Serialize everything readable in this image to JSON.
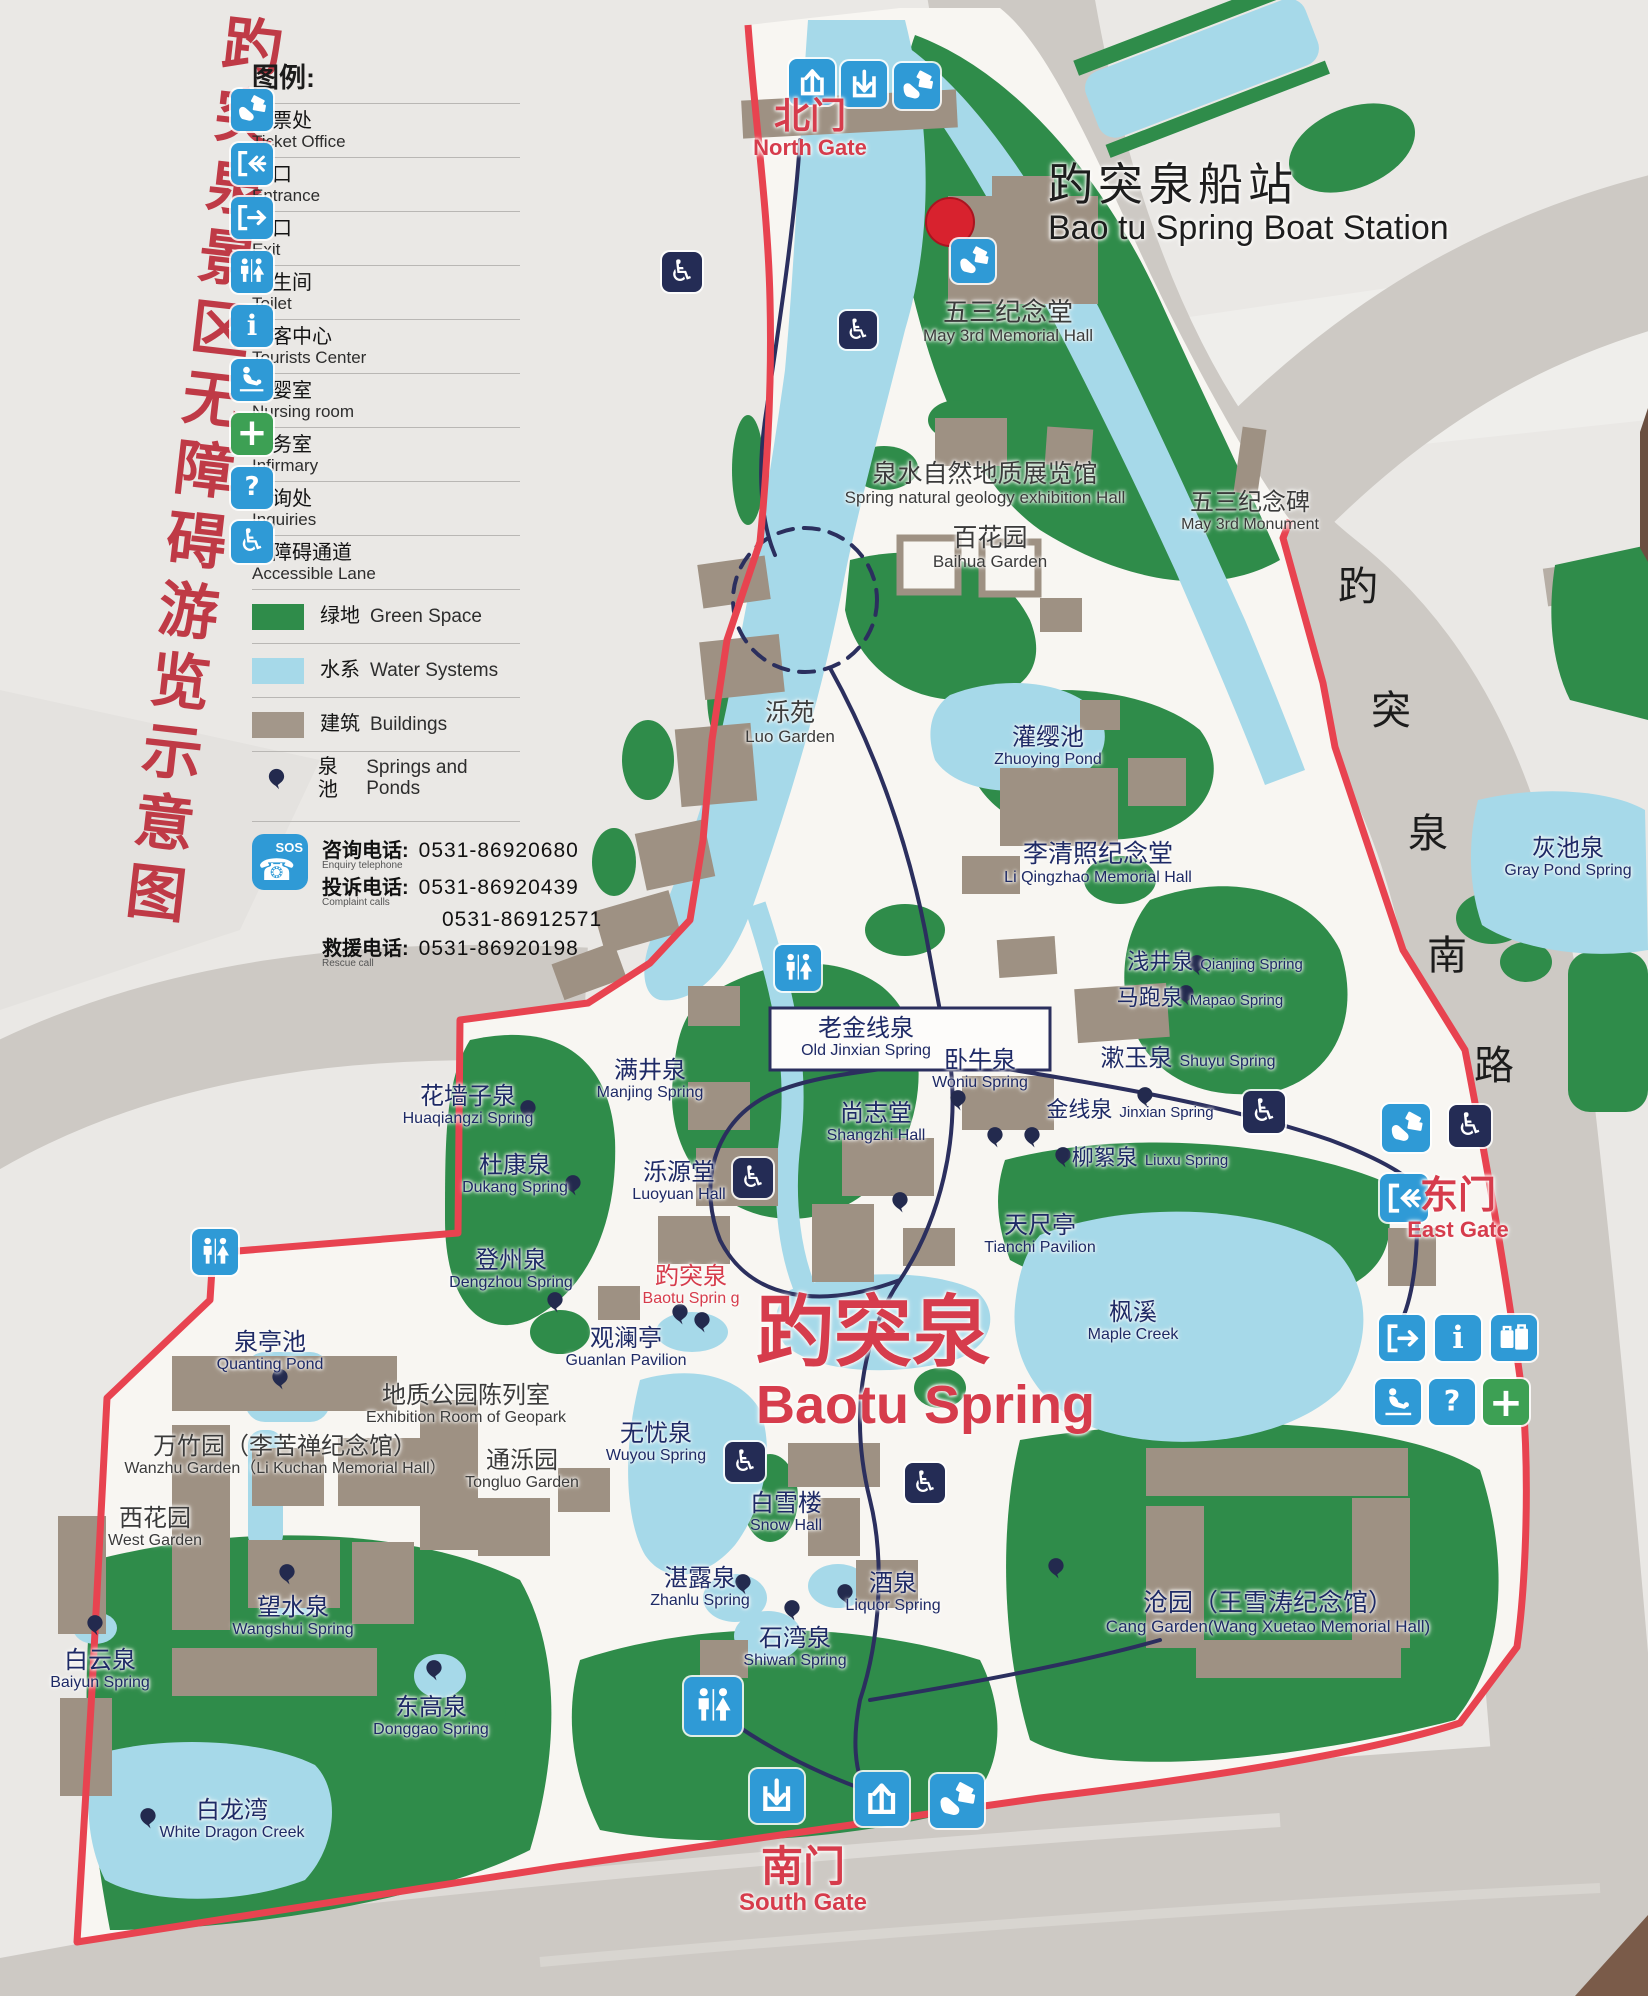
{
  "poster": {
    "vertical_title": "趵突泉景区无障碍游览示意图",
    "colors": {
      "title_red": "#bf3a46",
      "boundary_red": "#e84350",
      "gate_red": "#d63c4c",
      "label_navy": "#1e2a66",
      "green_space": "#2f8c4a",
      "water": "#a6d9e9",
      "building": "#9e9183",
      "road_gray": "#cdc9c4",
      "icon_blue": "#2f9ad6",
      "icon_navy": "#242c55",
      "infirmary_green": "#3da054"
    }
  },
  "legend": {
    "title": "图例:",
    "items": [
      {
        "id": "ticket-office",
        "icon": "ticket",
        "zh": "售票处",
        "en": "Ticket Office"
      },
      {
        "id": "entrance",
        "icon": "door-in",
        "zh": "入口",
        "en": "Entrance"
      },
      {
        "id": "exit",
        "icon": "door-out",
        "zh": "出口",
        "en": "Exit"
      },
      {
        "id": "toilet",
        "icon": "toilet",
        "zh": "卫生间",
        "en": "Toilet"
      },
      {
        "id": "tourists-center",
        "icon": "info",
        "zh": "游客中心",
        "en": "Tourists Center"
      },
      {
        "id": "nursing-room",
        "icon": "nursing",
        "zh": "母婴室",
        "en": "Nursing room"
      },
      {
        "id": "infirmary",
        "icon": "cross",
        "zh": "医务室",
        "en": "Infirmary"
      },
      {
        "id": "inquiries",
        "icon": "question",
        "zh": "咨询处",
        "en": "Inquiries"
      },
      {
        "id": "accessible-lane",
        "icon": "wheelchair-blue",
        "zh": "无障碍通道",
        "en": "Accessible Lane"
      },
      {
        "id": "green-space",
        "swatch": "green",
        "zh": "绿地",
        "en": "Green Space",
        "oneline": true
      },
      {
        "id": "water-systems",
        "swatch": "water",
        "zh": "水系",
        "en": "Water Systems",
        "oneline": true
      },
      {
        "id": "buildings",
        "swatch": "building",
        "zh": "建筑",
        "en": "Buildings",
        "oneline": true
      },
      {
        "id": "springs-and-ponds",
        "swatch": "balloon",
        "zh": "泉池",
        "en": "Springs and Ponds",
        "oneline": true
      }
    ],
    "phones": {
      "sos": "SOS",
      "rows": [
        {
          "zh": "咨询电话:",
          "en": "Enquiry telephone",
          "numbers": [
            "0531-86920680"
          ]
        },
        {
          "zh": "投诉电话:",
          "en": "Complaint calls",
          "numbers": [
            "0531-86920439",
            "0531-86912571"
          ]
        },
        {
          "zh": "救援电话:",
          "en": "Rescue call",
          "numbers": [
            "0531-86920198"
          ]
        }
      ]
    }
  },
  "map": {
    "road_name": {
      "text": "趵突泉南路",
      "chars": [
        {
          "ch": "趵",
          "x": 1358,
          "y": 583
        },
        {
          "ch": "突",
          "x": 1391,
          "y": 707
        },
        {
          "ch": "泉",
          "x": 1428,
          "y": 830
        },
        {
          "ch": "南",
          "x": 1447,
          "y": 952
        },
        {
          "ch": "路",
          "x": 1494,
          "y": 1062
        }
      ]
    },
    "labels": [
      {
        "id": "north-gate-label",
        "zh": "北门",
        "en": "North Gate",
        "x": 810,
        "y": 96,
        "c": "red",
        "zs": 36,
        "es": 22,
        "b": 1
      },
      {
        "id": "boat-station-label",
        "zh": "趵突泉船站",
        "en": "Bao tu Spring Boat Station",
        "x": 1048,
        "y": 160,
        "c": "black",
        "zs": 45,
        "es": 34,
        "align": "left",
        "ls": 5
      },
      {
        "id": "may3rd-hall-label",
        "zh": "五三纪念堂",
        "en": "May 3rd Memorial Hall",
        "x": 1008,
        "y": 298,
        "c": "dark",
        "zs": 26,
        "es": 17
      },
      {
        "id": "geology-hall-label",
        "zh": "泉水自然地质展览馆",
        "en": "Spring natural geology exhibition Hall",
        "x": 985,
        "y": 461,
        "c": "dark",
        "zs": 25,
        "es": 17
      },
      {
        "id": "baihua-garden-label",
        "zh": "百花园",
        "en": "Baihua Garden",
        "x": 990,
        "y": 525,
        "c": "dark",
        "zs": 25,
        "es": 17
      },
      {
        "id": "may3rd-monument-label",
        "zh": "五三纪念碑",
        "en": "May 3rd Monument",
        "x": 1250,
        "y": 490,
        "c": "dark",
        "zs": 24,
        "es": 16
      },
      {
        "id": "luo-garden-label",
        "zh": "泺苑",
        "en": "Luo Garden",
        "x": 790,
        "y": 700,
        "c": "dark",
        "zs": 25,
        "es": 17
      },
      {
        "id": "zhuoying-pond-label",
        "zh": "灌缨池",
        "en": "Zhuoying Pond",
        "x": 1048,
        "y": 725,
        "c": "navy",
        "zs": 24,
        "es": 16
      },
      {
        "id": "liqingzhao-hall-label",
        "zh": "李清照纪念堂",
        "en": "Li Qingzhao Memorial Hall",
        "x": 1098,
        "y": 841,
        "c": "navy",
        "zs": 25,
        "es": 16
      },
      {
        "id": "gray-pond-spring-label",
        "zh": "灰池泉",
        "en": "Gray Pond Spring",
        "x": 1568,
        "y": 836,
        "c": "navy",
        "zs": 24,
        "es": 16
      },
      {
        "id": "qianjing-spring-label",
        "zh": "浅井泉",
        "en": "Qianjing Spring",
        "x": 1215,
        "y": 950,
        "c": "navy",
        "zs": 22,
        "es": 15,
        "inline": 1
      },
      {
        "id": "mapao-spring-label",
        "zh": "马跑泉",
        "en": "Mapao Spring",
        "x": 1200,
        "y": 986,
        "c": "navy",
        "zs": 22,
        "es": 15,
        "inline": 1
      },
      {
        "id": "old-jinxian-spring-label",
        "zh": "老金线泉",
        "en": "Old Jinxian Spring",
        "x": 866,
        "y": 1016,
        "c": "navy",
        "zs": 24,
        "es": 16
      },
      {
        "id": "woniu-spring-label",
        "zh": "卧牛泉",
        "en": "Woniu Spring",
        "x": 980,
        "y": 1048,
        "c": "navy",
        "zs": 24,
        "es": 16
      },
      {
        "id": "shuyu-spring-label",
        "zh": "漱玉泉",
        "en": "Shuyu Spring",
        "x": 1188,
        "y": 1046,
        "c": "navy",
        "zs": 24,
        "es": 16,
        "inline": 1
      },
      {
        "id": "shangzhi-hall-label",
        "zh": "尚志堂",
        "en": "Shangzhi Hall",
        "x": 876,
        "y": 1101,
        "c": "navy",
        "zs": 24,
        "es": 16
      },
      {
        "id": "jinxian-spring-label",
        "zh": "金线泉",
        "en": "Jinxian Spring",
        "x": 1130,
        "y": 1098,
        "c": "navy",
        "zs": 22,
        "es": 15,
        "inline": 1
      },
      {
        "id": "liuxu-spring-label",
        "zh": "柳絮泉",
        "en": "Liuxu Spring",
        "x": 1150,
        "y": 1146,
        "c": "navy",
        "zs": 22,
        "es": 15,
        "inline": 1
      },
      {
        "id": "tianchi-pavilion-label",
        "zh": "天尺亭",
        "en": "Tianchi Pavilion",
        "x": 1040,
        "y": 1213,
        "c": "navy",
        "zs": 24,
        "es": 16
      },
      {
        "id": "huaqiangzi-spring-label",
        "zh": "花墙子泉",
        "en": "Huaqiangzi Spring",
        "x": 468,
        "y": 1084,
        "c": "navy",
        "zs": 24,
        "es": 16
      },
      {
        "id": "manjing-spring-label",
        "zh": "满井泉",
        "en": "Manjing Spring",
        "x": 650,
        "y": 1058,
        "c": "navy",
        "zs": 24,
        "es": 16
      },
      {
        "id": "dukang-spring-label",
        "zh": "杜康泉",
        "en": "Dukang Spring",
        "x": 515,
        "y": 1153,
        "c": "navy",
        "zs": 24,
        "es": 16
      },
      {
        "id": "luoyuan-hall-label",
        "zh": "泺源堂",
        "en": "Luoyuan Hall",
        "x": 679,
        "y": 1160,
        "c": "navy",
        "zs": 24,
        "es": 16
      },
      {
        "id": "dengzhou-spring-label",
        "zh": "登州泉",
        "en": "Dengzhou Spring",
        "x": 511,
        "y": 1248,
        "c": "navy",
        "zs": 24,
        "es": 16
      },
      {
        "id": "baotu-spring-small-label",
        "zh": "趵突泉",
        "en": "Baotu Sprin g",
        "x": 691,
        "y": 1264,
        "c": "red",
        "zs": 24,
        "es": 16
      },
      {
        "id": "guanlan-pavilion-label",
        "zh": "观澜亭",
        "en": "Guanlan Pavilion",
        "x": 626,
        "y": 1326,
        "c": "navy",
        "zs": 24,
        "es": 16
      },
      {
        "id": "baotu-spring-title",
        "zh": "趵突泉",
        "en": "Baotu Spring",
        "x": 756,
        "y": 1290,
        "c": "red",
        "zs": 78,
        "es": 54,
        "align": "left",
        "b": 1
      },
      {
        "id": "maple-creek-label",
        "zh": "枫溪",
        "en": "Maple Creek",
        "x": 1133,
        "y": 1300,
        "c": "navy",
        "zs": 24,
        "es": 16
      },
      {
        "id": "wuyou-spring-label",
        "zh": "无忧泉",
        "en": "Wuyou Spring",
        "x": 656,
        "y": 1421,
        "c": "navy",
        "zs": 24,
        "es": 16
      },
      {
        "id": "snow-hall-label",
        "zh": "白雪楼",
        "en": "Snow Hall",
        "x": 786,
        "y": 1491,
        "c": "navy",
        "zs": 24,
        "es": 16
      },
      {
        "id": "zhanlu-spring-label",
        "zh": "湛露泉",
        "en": "Zhanlu Spring",
        "x": 700,
        "y": 1566,
        "c": "navy",
        "zs": 24,
        "es": 16
      },
      {
        "id": "liquor-spring-label",
        "zh": "酒泉",
        "en": "Liquor Spring",
        "x": 893,
        "y": 1571,
        "c": "navy",
        "zs": 24,
        "es": 16
      },
      {
        "id": "shiwan-spring-label",
        "zh": "石湾泉",
        "en": "Shiwan Spring",
        "x": 795,
        "y": 1626,
        "c": "navy",
        "zs": 24,
        "es": 16
      },
      {
        "id": "east-gate-label",
        "zh": "东门",
        "en": "East Gate",
        "x": 1458,
        "y": 1176,
        "c": "red",
        "zs": 38,
        "es": 22,
        "b": 1
      },
      {
        "id": "south-gate-label",
        "zh": "南门",
        "en": "South Gate",
        "x": 803,
        "y": 1844,
        "c": "red",
        "zs": 42,
        "es": 24,
        "b": 1
      },
      {
        "id": "quanting-pond-label",
        "zh": "泉亭池",
        "en": "Quanting Pond",
        "x": 270,
        "y": 1330,
        "c": "navy",
        "zs": 24,
        "es": 16
      },
      {
        "id": "geopark-room-label",
        "zh": "地质公园陈列室",
        "en": "Exhibition Room of Geopark",
        "x": 466,
        "y": 1383,
        "c": "dark",
        "zs": 24,
        "es": 16
      },
      {
        "id": "wanzhu-garden-label",
        "zh": "万竹园（李苦禅纪念馆）",
        "en": "Wanzhu Garden（Li Kuchan Memorial Hall）",
        "x": 285,
        "y": 1434,
        "c": "dark",
        "zs": 24,
        "es": 16
      },
      {
        "id": "west-garden-label",
        "zh": "西花园",
        "en": "West Garden",
        "x": 155,
        "y": 1506,
        "c": "dark",
        "zs": 24,
        "es": 16
      },
      {
        "id": "tongluo-garden-label",
        "zh": "通泺园",
        "en": "Tongluo Garden",
        "x": 522,
        "y": 1448,
        "c": "dark",
        "zs": 24,
        "es": 16
      },
      {
        "id": "wangshui-spring-label",
        "zh": "望水泉",
        "en": "Wangshui Spring",
        "x": 293,
        "y": 1595,
        "c": "navy",
        "zs": 24,
        "es": 16
      },
      {
        "id": "baiyun-spring-label",
        "zh": "白云泉",
        "en": "Baiyun Spring",
        "x": 100,
        "y": 1648,
        "c": "navy",
        "zs": 24,
        "es": 16
      },
      {
        "id": "donggao-spring-label",
        "zh": "东高泉",
        "en": "Donggao Spring",
        "x": 431,
        "y": 1695,
        "c": "navy",
        "zs": 24,
        "es": 16
      },
      {
        "id": "white-dragon-creek-label",
        "zh": "白龙湾",
        "en": "White Dragon Creek",
        "x": 232,
        "y": 1798,
        "c": "navy",
        "zs": 24,
        "es": 16
      },
      {
        "id": "cang-garden-label",
        "zh": "沧园（王雪涛纪念馆）",
        "en": "Cang Garden(Wang Xuetao Memorial Hall)",
        "x": 1268,
        "y": 1590,
        "c": "navy",
        "zs": 25,
        "es": 17
      }
    ],
    "icons": [
      {
        "type": "exit-up",
        "x": 812,
        "y": 82,
        "s": 46
      },
      {
        "type": "enter-down",
        "x": 864,
        "y": 84,
        "s": 46
      },
      {
        "type": "ticket",
        "x": 917,
        "y": 86,
        "s": 46
      },
      {
        "type": "ticket",
        "x": 973,
        "y": 261,
        "s": 44
      },
      {
        "type": "wheelchair",
        "x": 682,
        "y": 272,
        "s": 40
      },
      {
        "type": "wheelchair",
        "x": 858,
        "y": 330,
        "s": 38
      },
      {
        "type": "toilet",
        "x": 798,
        "y": 968,
        "s": 46
      },
      {
        "type": "wheelchair",
        "x": 753,
        "y": 1178,
        "s": 40
      },
      {
        "type": "toilet",
        "x": 215,
        "y": 1252,
        "s": 46
      },
      {
        "type": "wheelchair",
        "x": 1264,
        "y": 1112,
        "s": 42
      },
      {
        "type": "ticket",
        "x": 1406,
        "y": 1128,
        "s": 48
      },
      {
        "type": "wheelchair",
        "x": 1470,
        "y": 1126,
        "s": 42
      },
      {
        "type": "door-in",
        "x": 1404,
        "y": 1198,
        "s": 48
      },
      {
        "type": "wheelchair",
        "x": 745,
        "y": 1462,
        "s": 40
      },
      {
        "type": "wheelchair",
        "x": 925,
        "y": 1483,
        "s": 40
      },
      {
        "type": "door-out",
        "x": 1402,
        "y": 1338,
        "s": 46
      },
      {
        "type": "info",
        "x": 1458,
        "y": 1338,
        "s": 46
      },
      {
        "type": "luggage",
        "x": 1514,
        "y": 1338,
        "s": 46
      },
      {
        "type": "nursing",
        "x": 1398,
        "y": 1402,
        "s": 46
      },
      {
        "type": "question",
        "x": 1452,
        "y": 1402,
        "s": 46
      },
      {
        "type": "cross",
        "x": 1506,
        "y": 1402,
        "s": 46
      },
      {
        "type": "toilet",
        "x": 713,
        "y": 1706,
        "s": 58
      },
      {
        "type": "enter-down",
        "x": 777,
        "y": 1796,
        "s": 54
      },
      {
        "type": "exit-up",
        "x": 882,
        "y": 1799,
        "s": 54
      },
      {
        "type": "ticket",
        "x": 957,
        "y": 1801,
        "s": 54
      }
    ],
    "spring_markers": [
      {
        "x": 528,
        "y": 1118
      },
      {
        "x": 573,
        "y": 1193
      },
      {
        "x": 555,
        "y": 1310
      },
      {
        "x": 680,
        "y": 1322
      },
      {
        "x": 702,
        "y": 1330
      },
      {
        "x": 958,
        "y": 1108
      },
      {
        "x": 995,
        "y": 1145
      },
      {
        "x": 1032,
        "y": 1145
      },
      {
        "x": 1063,
        "y": 1165
      },
      {
        "x": 1145,
        "y": 1105
      },
      {
        "x": 1197,
        "y": 973
      },
      {
        "x": 1186,
        "y": 1003
      },
      {
        "x": 900,
        "y": 1210
      },
      {
        "x": 743,
        "y": 1592
      },
      {
        "x": 845,
        "y": 1602
      },
      {
        "x": 792,
        "y": 1618
      },
      {
        "x": 280,
        "y": 1387
      },
      {
        "x": 287,
        "y": 1582
      },
      {
        "x": 95,
        "y": 1633
      },
      {
        "x": 434,
        "y": 1678
      },
      {
        "x": 148,
        "y": 1826
      },
      {
        "x": 1056,
        "y": 1576
      }
    ]
  }
}
